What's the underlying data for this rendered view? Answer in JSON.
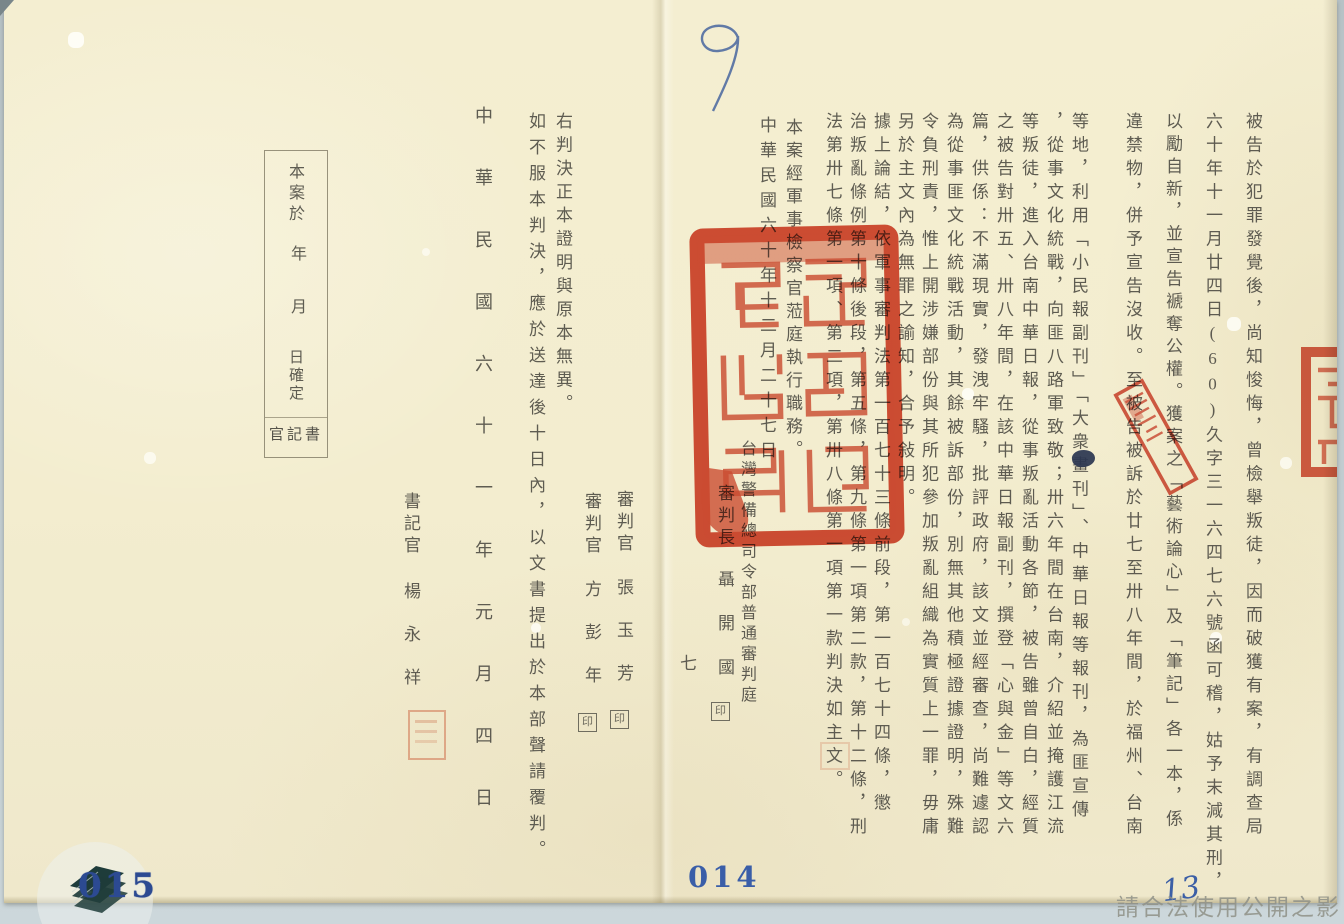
{
  "document_type": "軍事判決正本（檔案掃描）",
  "page_right": {
    "body_columns": [
      "被告於犯罪發覺後，尚知悛悔，曾檢舉叛徒，因而破獲有案，有調查局",
      "六十年十一月廿四日(60)久字三一六四七六號函可稽，姑予末減其刑，",
      "以勵自新，並宣告褫奪公權。獲案之「藝術論心」及「筆記」各一本，係",
      "違禁物，併予宣告沒收。至被告被訴於廿七至卅八年間，於福州、台南",
      "等地，利用「小民報副刊」「大衆畫刊」、中華日報等報刊，為匪宣傳",
      "，從事文化統戰，向匪八路軍致敬；卅六年間在台南，介紹並掩護江流",
      "等叛徒，進入台南中華日報，從事叛亂活動各節，被告雖曾自白，經質",
      "之被告對卅五、卅八年間，在該中華日報副刊，撰登「心與金」等文六",
      "篇，供係：不滿現實，發洩牢騷，批評政府，該文並經審查，尚難遽認",
      "為從事匪文化統戰活動，其餘被訴部份，別無其他積極證據證明，殊難",
      "令負刑責，惟上開涉嫌部份與其所犯參加叛亂組織為實質上一罪，毋庸",
      "另於主文內為無罪之諭知，合予敍明。",
      "據上論結，依軍事審判法第一百七十三條前段，第一百七十四條，懲",
      "治叛亂條例第十條後段，第五條，第九條第一項第二款，第十二條，刑",
      "法第卅七條第一項、第二項，第卅八條第一項第一款判決如主文。"
    ],
    "closing_column": "本案經軍事檢察官蒞庭執行職務。",
    "judgment_date_column": "中華民國六十年十二月二十七日",
    "court_column": "台灣警備總司令部普通審判庭",
    "presiding_judge": {
      "title": "審判長",
      "name": "聶開國",
      "seal_char": "印"
    }
  },
  "page_left": {
    "certify_column": "右判決正本證明與原本無異。",
    "appeal_column": "如不服本判決，應於送達後十日內，以文書提出於本部聲請覆判。",
    "date_column": "中華民國六十一年元月四日",
    "judges": [
      {
        "title": "審判官",
        "name": "張玉芳",
        "seal_char": "印"
      },
      {
        "title": "審判官",
        "name": "方彭年",
        "seal_char": "印"
      }
    ],
    "clerk": {
      "title": "書記官",
      "name": "楊永祥"
    },
    "confirmation_box": {
      "line1": "本案於",
      "year": "年",
      "month": "月",
      "day_confirm": "日確定",
      "footer": "官記書"
    }
  },
  "fold": {
    "page_number": "七"
  },
  "annotations": {
    "handwritten_top": "9",
    "handwritten_bottom_right": "13",
    "page_stamp_left": "015",
    "page_stamp_center": "014",
    "watermark_text": "請合法使用公開之影像"
  },
  "colors": {
    "paper": "#f3edcf",
    "ink": "#55534a",
    "seal_red": "#cf3a22",
    "stamp_blue": "#2f4f96",
    "handwriting_blue": "#4668a6",
    "watermark_gray": "#8f9187"
  }
}
